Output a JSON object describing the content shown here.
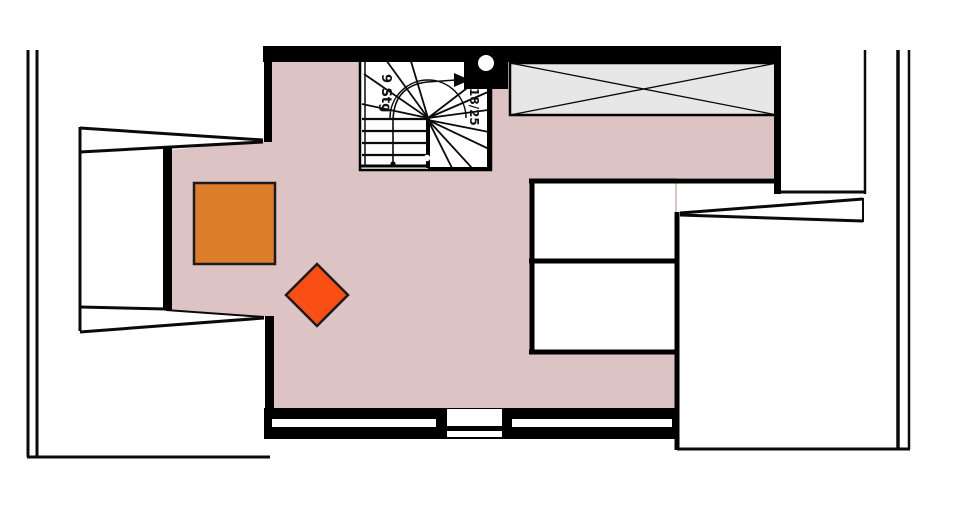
{
  "plan": {
    "stair": {
      "label_left": "9 Stg",
      "label_right": "18/25"
    }
  },
  "colors": {
    "floor": "#DEC3C4",
    "wall": "#000000",
    "line": "#0a0a0a",
    "roof_window_fill": "#E7E7E7",
    "furniture_square": "#DD7E2D",
    "furniture_diamond": "#F94F15",
    "shape_outline": "#1b1b1b",
    "white": "#ffffff"
  }
}
